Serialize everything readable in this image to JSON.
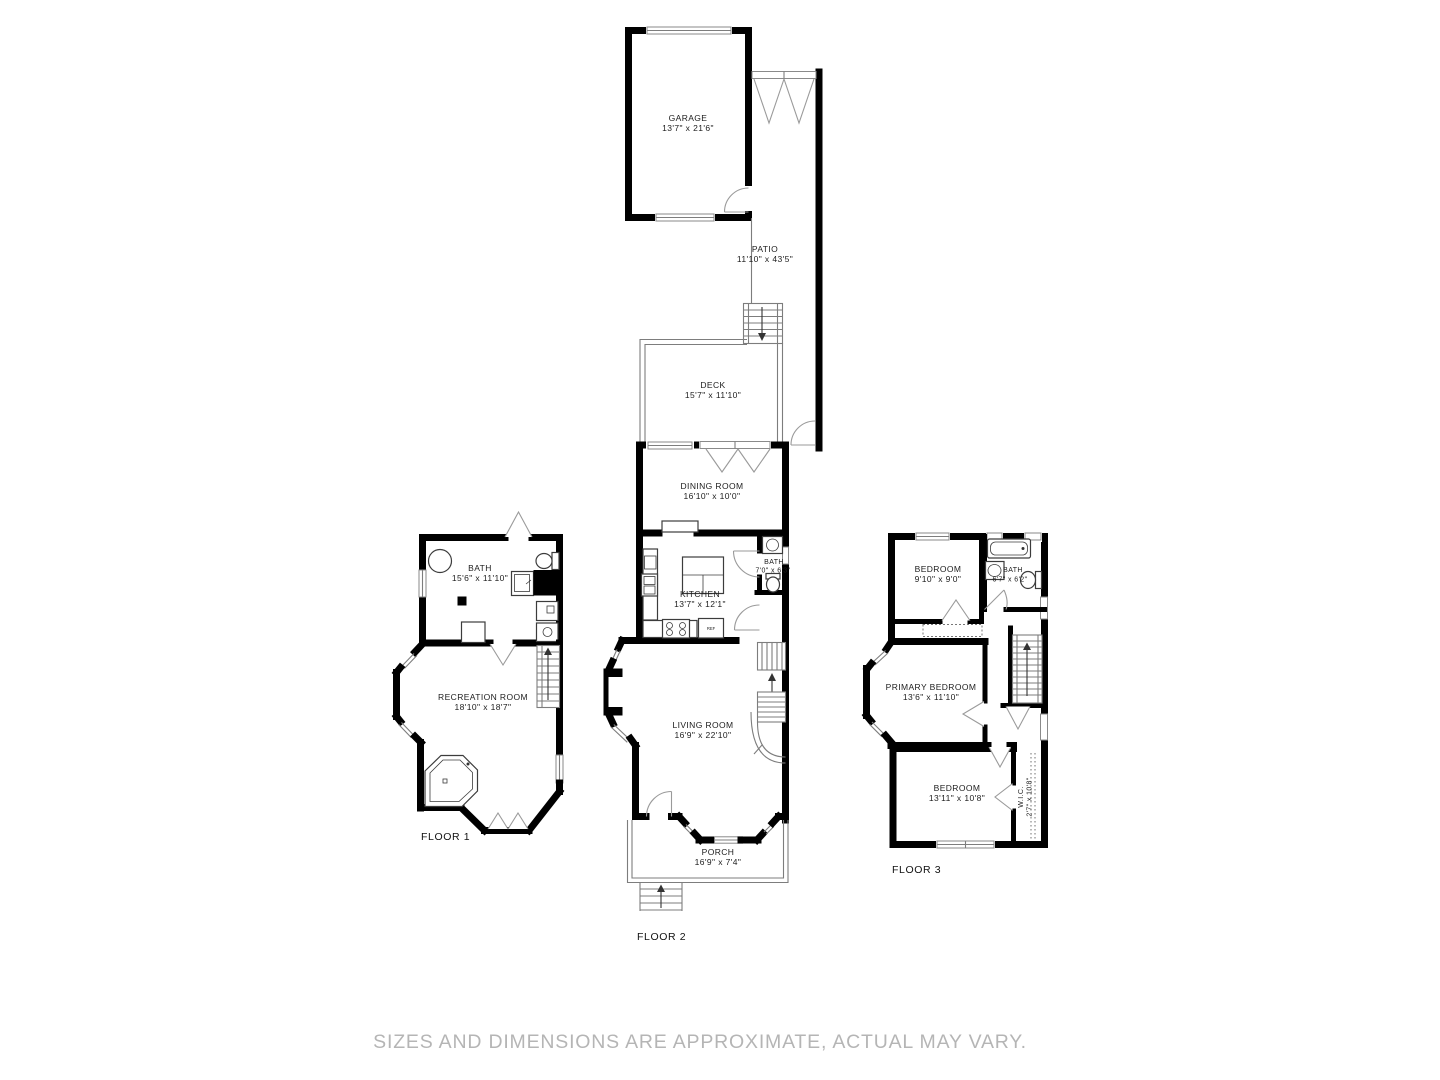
{
  "disclaimer": "SIZES AND DIMENSIONS ARE APPROXIMATE, ACTUAL MAY VARY.",
  "floor_labels": {
    "floor1": "FLOOR 1",
    "floor2": "FLOOR 2",
    "floor3": "FLOOR 3"
  },
  "rooms": {
    "garage": {
      "name": "GARAGE",
      "dims": "13'7\" x 21'6\""
    },
    "patio": {
      "name": "PATIO",
      "dims": "11'10\" x 43'5\""
    },
    "deck": {
      "name": "DECK",
      "dims": "15'7\" x 11'10\""
    },
    "dining": {
      "name": "DINING ROOM",
      "dims": "16'10\" x 10'0\""
    },
    "kitchen": {
      "name": "KITCHEN",
      "dims": "13'7\" x 12'1\""
    },
    "bath_main": {
      "name": "BATH",
      "dims": "7'0\" x 6'3\""
    },
    "living": {
      "name": "LIVING ROOM",
      "dims": "16'9\" x 22'10\""
    },
    "porch": {
      "name": "PORCH",
      "dims": "16'9\" x 7'4\""
    },
    "bath_lower": {
      "name": "BATH",
      "dims": "15'6\" x 11'10\""
    },
    "recreation": {
      "name": "RECREATION ROOM",
      "dims": "18'10\" x 18'7\""
    },
    "bedroom_top": {
      "name": "BEDROOM",
      "dims": "9'10\" x 9'0\""
    },
    "bath_upper": {
      "name": "BATH",
      "dims": "6'7\" x 6'2\""
    },
    "primary": {
      "name": "PRIMARY BEDROOM",
      "dims": "13'6\" x 11'10\""
    },
    "bedroom_bottom": {
      "name": "BEDROOM",
      "dims": "13'11\" x 10'8\""
    },
    "wic": {
      "name": "W.I.C.",
      "dims": "2'7\" x 10'8\""
    }
  },
  "appliances": {
    "fridge": "REF"
  },
  "colors": {
    "wall": "#000000",
    "outline": "#7d7d7d",
    "label": "#1d1d1d",
    "disclaimer": "#b5b5b5",
    "background": "#ffffff"
  }
}
